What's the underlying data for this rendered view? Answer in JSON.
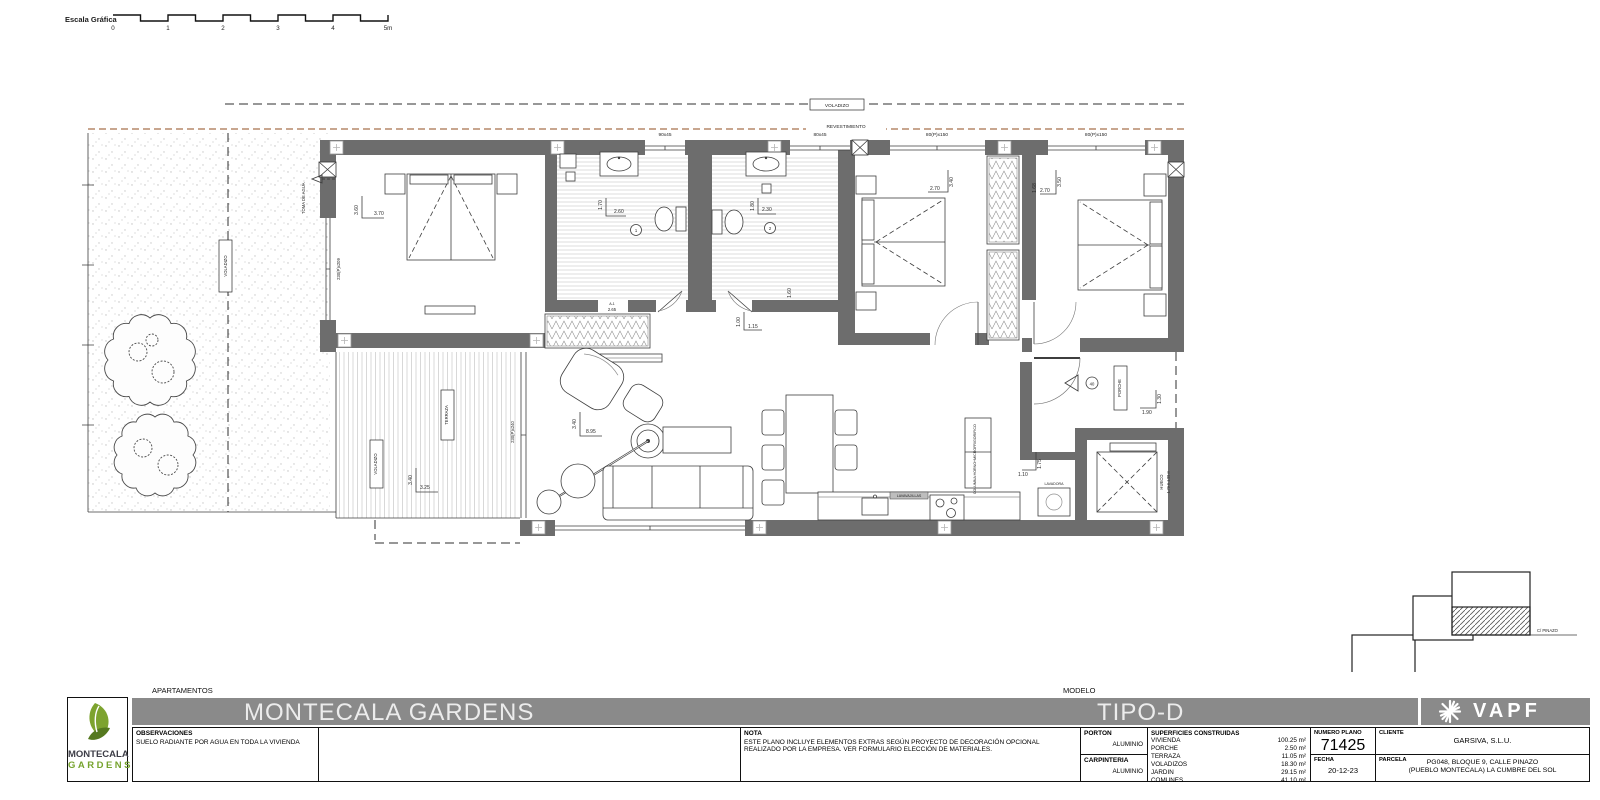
{
  "colors": {
    "wall_gray": "#6d6d6d",
    "band_gray": "#8a8a8a",
    "logo_green": "#76a32e",
    "revestimiento_tan": "#b5886a"
  },
  "scale_bar": {
    "label": "Escala Gráfica",
    "ticks": [
      "0",
      "1",
      "2",
      "3",
      "4",
      "5m"
    ]
  },
  "site_plan": {
    "street_label": "C/ PINAZO"
  },
  "plan": {
    "voladizo": "VOLADIZO",
    "revestimiento": "REVESTIMIENTO",
    "terraza": "TERRAZA",
    "porche": "PORCHE",
    "toma_de_agua": "TOMA DE AGUA",
    "hueco_title": "HUECO",
    "hueco_size": "1.79 X 1.55 m",
    "lavadora": "LAVADORA",
    "lavavajillas": "LAVAVAJILLAS",
    "frigorifico": "FRIGORIFICO",
    "columna_horno": "COLUMNA HORNO+MICRO",
    "armario_code": "A-1",
    "armario_dim": "2.65",
    "entry_num": "40",
    "bath1_num": "1",
    "bath2_num": "2",
    "windows": {
      "bath1": "90x45",
      "bath2": "80x45",
      "bed2": "80(P)x150",
      "bed3": "80(P)x150",
      "master": "230(P)x209",
      "terraza": "230(P)x240"
    },
    "dims": {
      "master_v": "3.60",
      "master_h": "3.70",
      "bath1_v": "1.70",
      "bath1_h": "2.60",
      "bath2_v": "1.80",
      "bath2_h": "2.30",
      "bed2_v": "3.40",
      "bed2_h": "2.70",
      "bed3_v": "3.50",
      "bed3_h": "2.70",
      "bed3_extra": "1.68",
      "living_v": "3.40",
      "living_h": "8.95",
      "terraza_v": "3.40",
      "terraza_h": "3.25",
      "hall_v": "1.00",
      "hall_h": "1.15",
      "hall_right": "1.60",
      "porch_v": "1.30",
      "porch_h": "1.90",
      "kitchen_v": "1.75",
      "kitchen_h": "1.10"
    }
  },
  "title_block": {
    "apartments_label": "APARTAMENTOS",
    "project_title": "MONTECALA GARDENS",
    "modelo_label": "MODELO",
    "modelo_value": "TIPO-D",
    "observaciones_label": "OBSERVACIONES",
    "observaciones_text": "SUELO RADIANTE POR AGUA EN TODA LA VIVIENDA",
    "nota_label": "NOTA",
    "nota_line1": "ESTE PLANO INCLUYE ELEMENTOS EXTRAS SEGÚN PROYECTO DE DECORACIÓN OPCIONAL",
    "nota_line2": "REALIZADO POR LA EMPRESA. VER FORMULARIO ELECCIÓN DE MATERIALES.",
    "porton_label": "PORTON",
    "porton_value": "ALUMINIO",
    "carpinteria_label": "CARPINTERIA",
    "carpinteria_value": "ALUMINIO",
    "superficies_label": "SUPERFICIES CONSTRUIDAS",
    "superficies": [
      {
        "name": "VIVIENDA",
        "value": "100.25 m²"
      },
      {
        "name": "PORCHE",
        "value": "2.50 m²"
      },
      {
        "name": "TERRAZA",
        "value": "11.05 m²"
      },
      {
        "name": "VOLADIZOS",
        "value": "18.30 m²"
      },
      {
        "name": "JARDIN",
        "value": "29.15 m²"
      },
      {
        "name": "COMUNES",
        "value": "41.10 m²"
      }
    ],
    "numero_plano_label": "NUMERO PLANO",
    "numero_plano": "71425",
    "fecha_label": "FECHA",
    "fecha": "20-12-23",
    "cliente_label": "CLIENTE",
    "cliente": "GARSIVA, S.L.U.",
    "parcela_label": "PARCELA",
    "parcela_line1": "PG048, BLOQUE 9, CALLE PINAZO",
    "parcela_line2": "(PUEBLO MONTECALA) LA CUMBRE DEL SOL",
    "logo_line1": "MONTECALA",
    "logo_line2": "GARDENS",
    "vapf": "VAPF"
  }
}
